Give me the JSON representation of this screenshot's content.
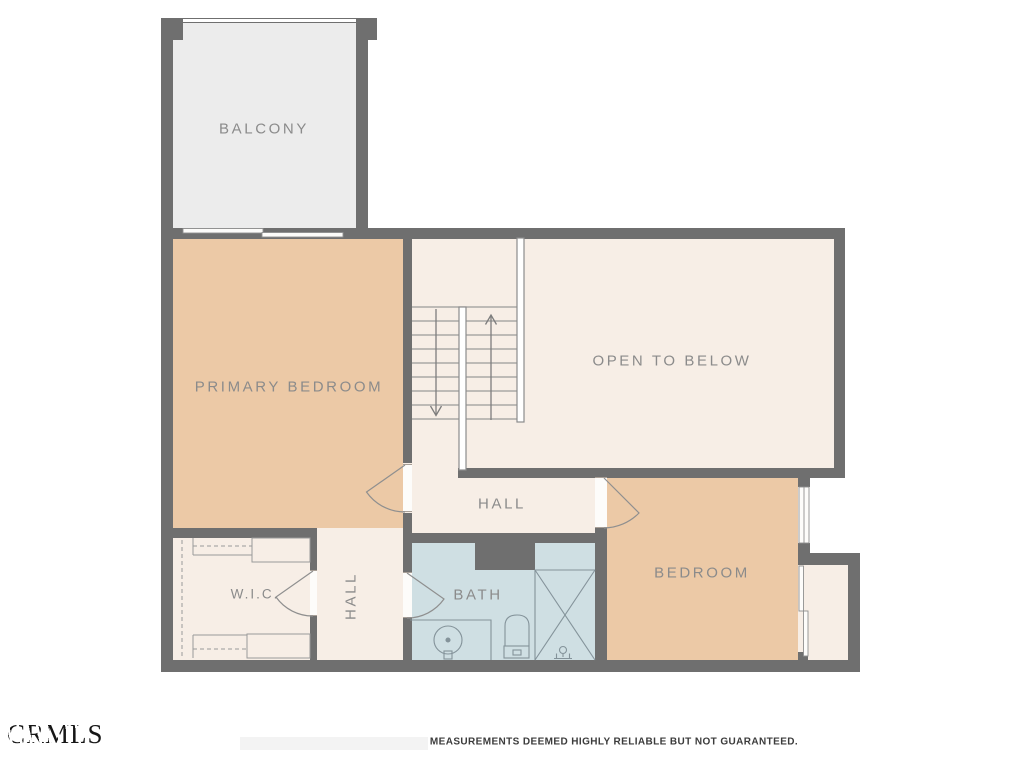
{
  "title": "Upper floor plan",
  "colors": {
    "wall": "#6f6f6f",
    "floor_cream": "#f7eee6",
    "floor_tan": "#ecc9a6",
    "floor_gray": "#ececec",
    "floor_blue": "#cfdfe3",
    "line": "#9a9a9a",
    "fixture_line": "#84939a",
    "label": "#8b8b8b",
    "disclaimer_text": "#3b3b3b"
  },
  "rooms": {
    "balcony": {
      "label": "BALCONY"
    },
    "primary_bedroom": {
      "label": "PRIMARY BEDROOM"
    },
    "open_to_below": {
      "label": "OPEN TO BELOW"
    },
    "hall": {
      "label": "HALL"
    },
    "hall_vertical": {
      "label": "HALL"
    },
    "wic": {
      "label": "W.I.C."
    },
    "bath": {
      "label": "BATH"
    },
    "bedroom": {
      "label": "BEDROOM"
    }
  },
  "footer": {
    "watermark": "CRMLS",
    "disclaimer": "MEASUREMENTS DEEMED HIGHLY RELIABLE BUT NOT GUARANTEED."
  }
}
